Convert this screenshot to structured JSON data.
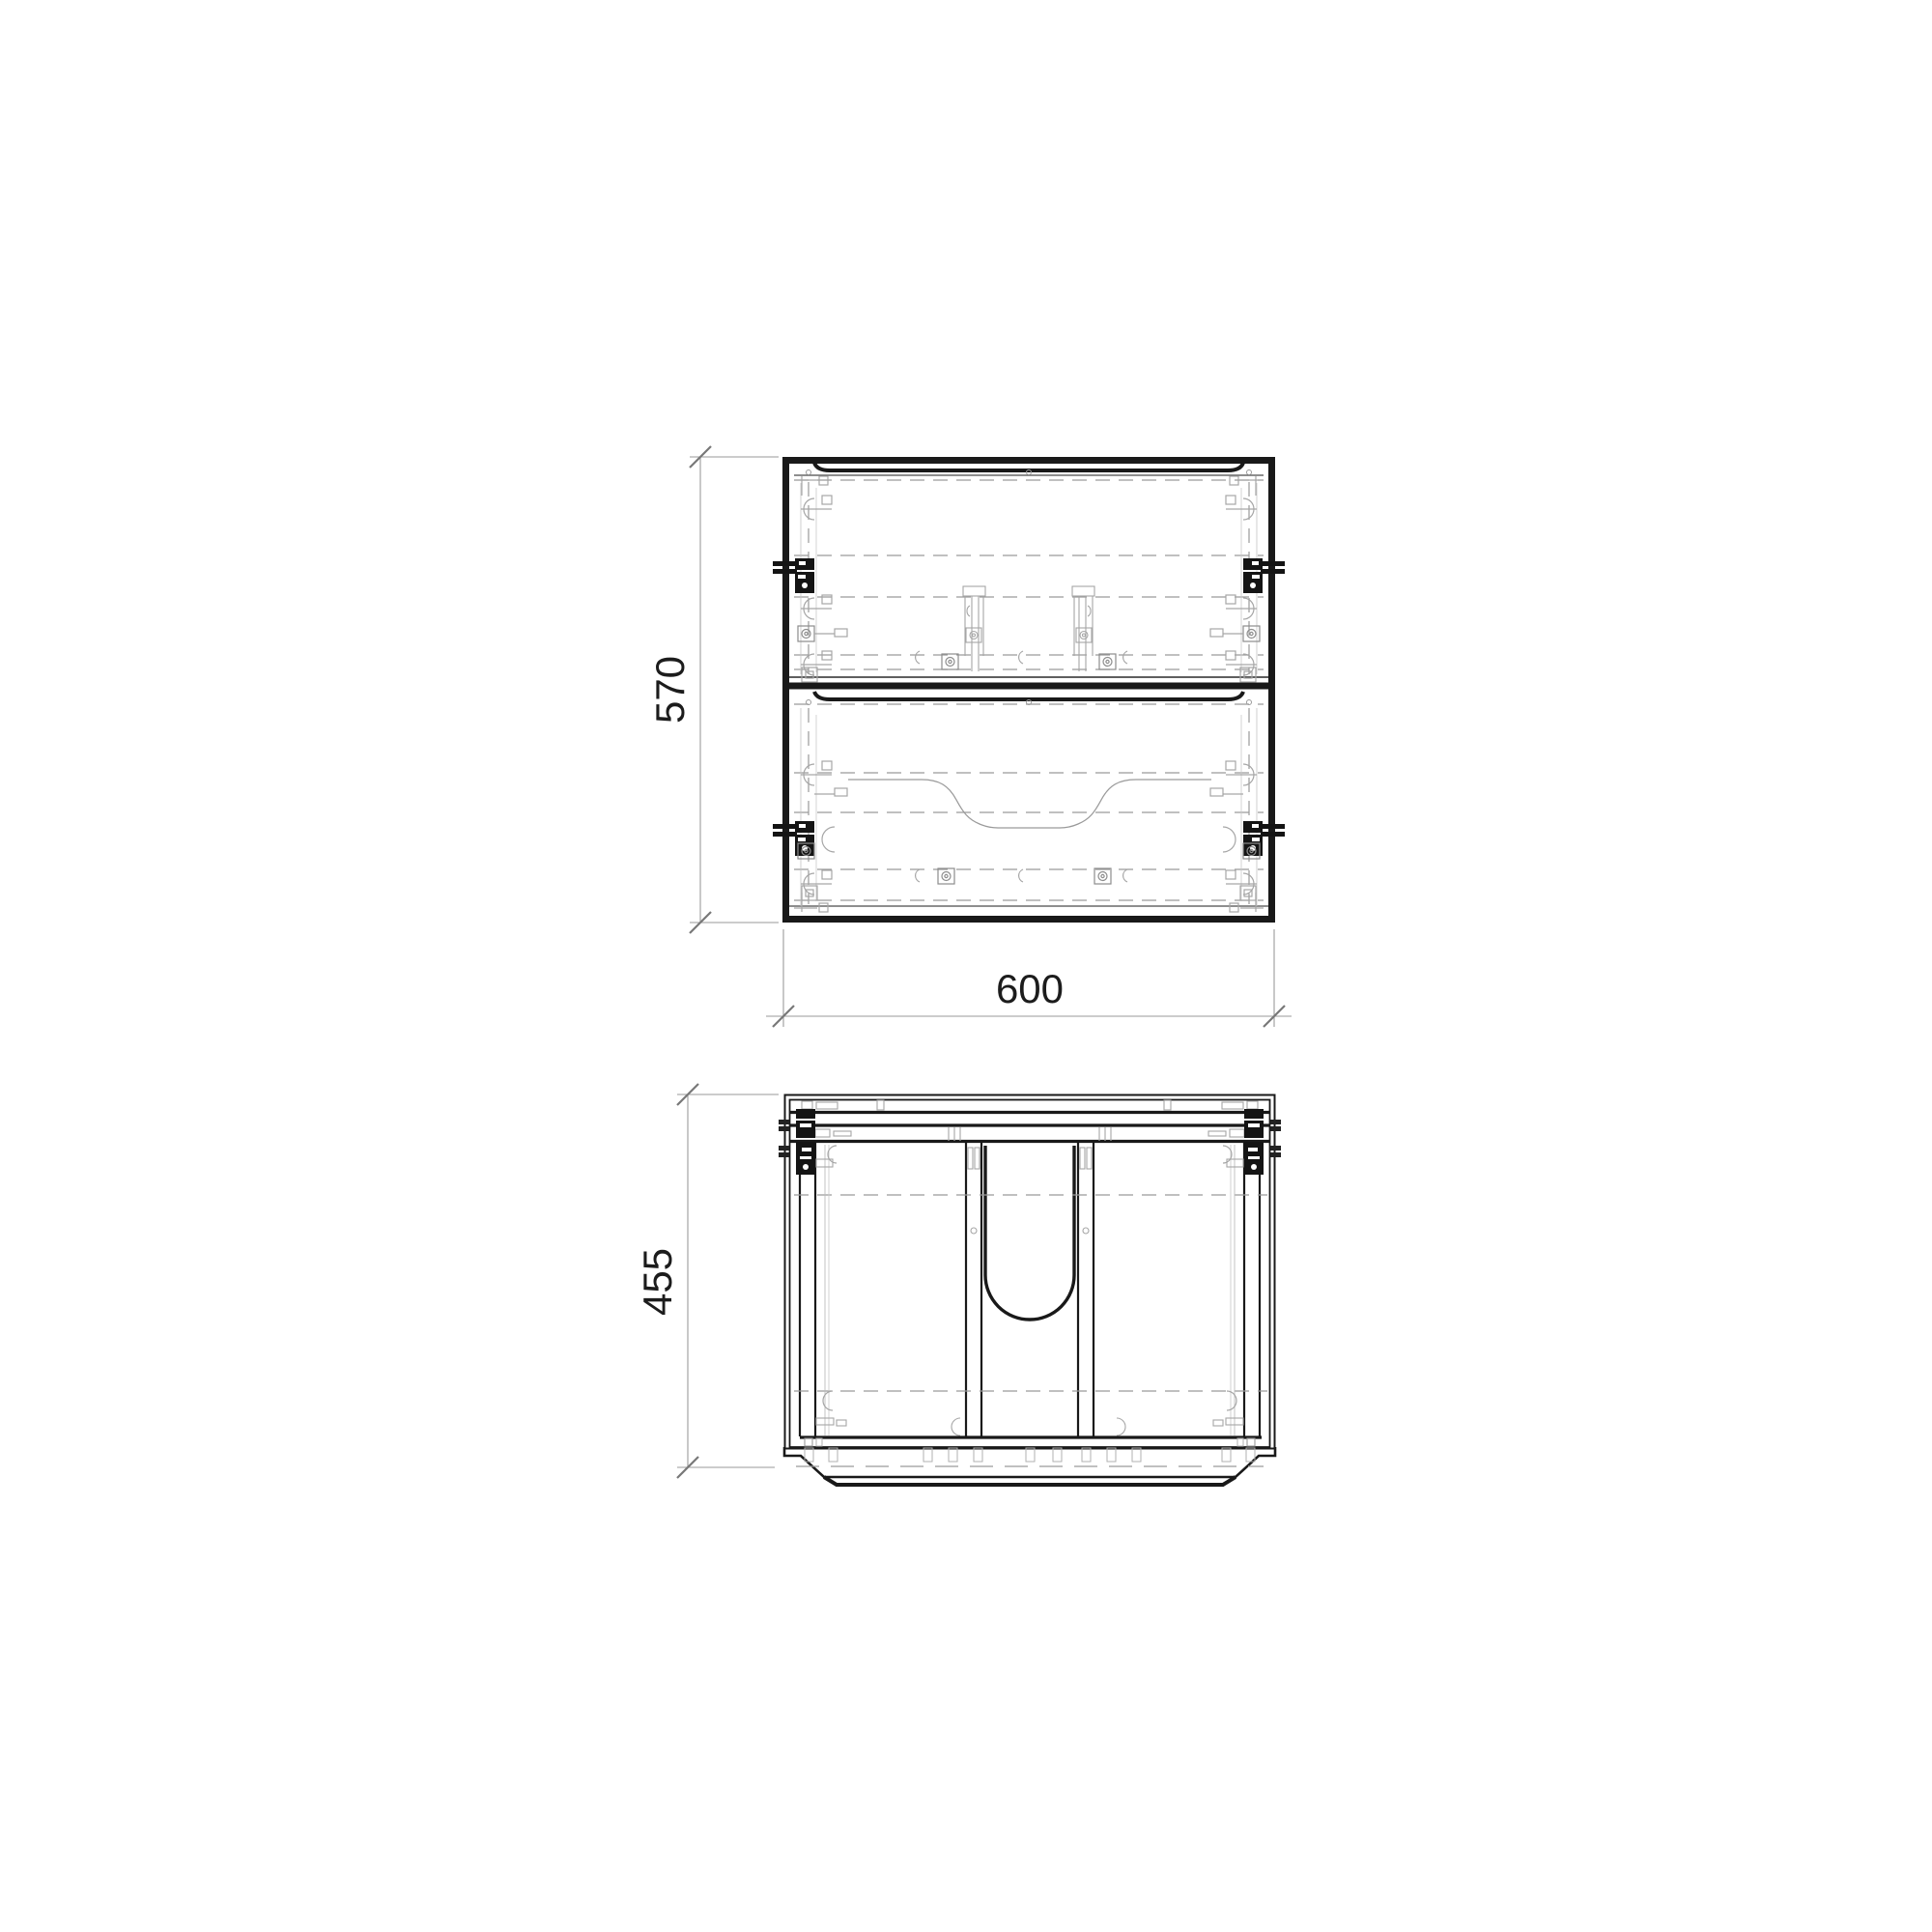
{
  "drawing": {
    "type": "technical-2d-cabinet-drawing",
    "views": {
      "front": {
        "name": "front elevation",
        "width_label": "600",
        "height_label": "570"
      },
      "plan": {
        "name": "plan view",
        "depth_label": "455"
      }
    },
    "dimensions": {
      "front_height": {
        "value": "570",
        "orientation": "vertical"
      },
      "front_width": {
        "value": "600",
        "orientation": "horizontal"
      },
      "plan_depth": {
        "value": "455",
        "orientation": "vertical"
      }
    },
    "colors": {
      "line": "#191919",
      "hidden_line": "#9a9a9a",
      "hardware": "#a6a6a6",
      "dimension_line": "#9a9a9a",
      "tick": "#787878",
      "text": "#1c1c1c",
      "background": "#ffffff"
    }
  }
}
